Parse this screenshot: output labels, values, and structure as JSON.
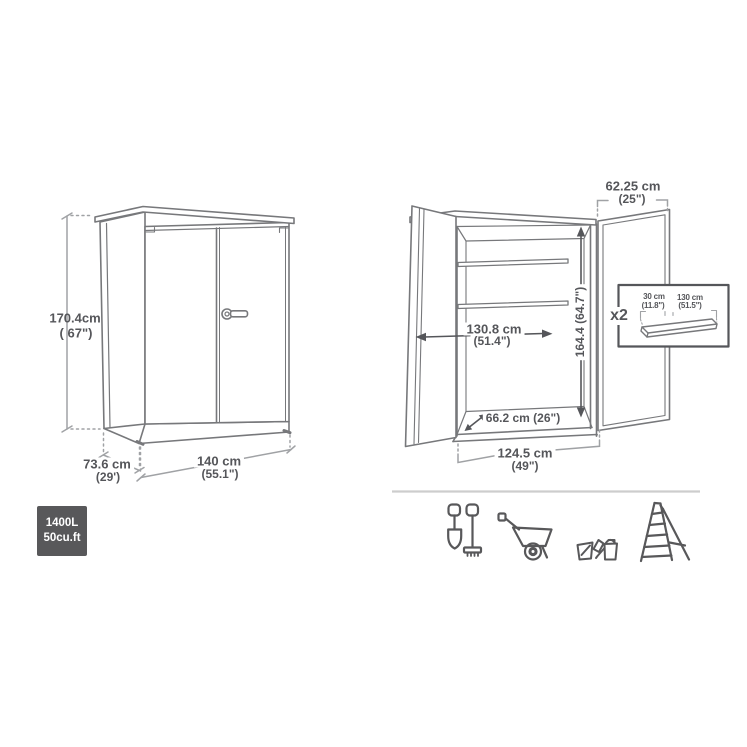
{
  "closed_view": {
    "height_cm": "170.4cm",
    "height_in": "( 67\")",
    "depth_cm": "73.6 cm",
    "depth_in": "(29')",
    "width_cm": "140 cm",
    "width_in": "(55.1\")"
  },
  "open_view": {
    "door_width_cm": "62.25 cm",
    "door_width_in": "(25\")",
    "interior_width_cm": "130.8 cm",
    "interior_width_in": "(51.4\")",
    "interior_height": "164.4 (64.7\")",
    "interior_depth": "66.2 cm (26\")",
    "opening_width_cm": "124.5 cm",
    "opening_width_in": "(49\")"
  },
  "shelf_inset": {
    "quantity": "x2",
    "shelf_depth_cm": "30 cm",
    "shelf_depth_in": "(11.8\")",
    "shelf_width_cm": "130 cm",
    "shelf_width_in": "(51.5\")"
  },
  "capacity_badge": {
    "liters": "1400L",
    "cubic_feet": "50cu.ft"
  },
  "footer_icons": [
    "garden-tools",
    "wheelbarrow",
    "watering-can",
    "ladder"
  ],
  "colors": {
    "line": "#77787b",
    "dimension_line": "#a0a2a5",
    "text": "#55565a",
    "badge_background": "#58585a",
    "badge_text": "#ffffff",
    "separator": "#cdcdcd"
  }
}
